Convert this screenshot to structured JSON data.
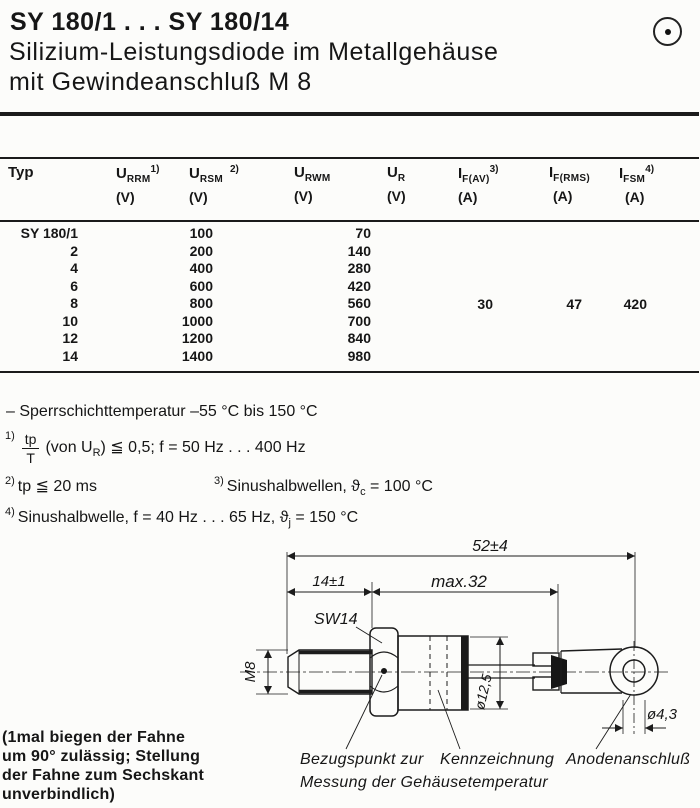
{
  "header": {
    "title": "SY 180/1 . . . SY 180/14",
    "subtitle_line1": "Silizium-Leistungsdiode im Metallgehäuse",
    "subtitle_line2": "mit Gewindeanschluß M 8",
    "logo_icon": "circle-dot-icon"
  },
  "table": {
    "columns": [
      {
        "base": "Typ",
        "sub": "",
        "sup": "",
        "unit": ""
      },
      {
        "base": "U",
        "sub": "RRM",
        "sup": "1)",
        "unit": "(V)"
      },
      {
        "base": "U",
        "sub": "RSM",
        "sup": "2)",
        "unit": "(V)"
      },
      {
        "base": "U",
        "sub": "RWM",
        "sup": "",
        "unit": "(V)"
      },
      {
        "base": "U",
        "sub": "R",
        "sup": "",
        "unit": "(V)"
      },
      {
        "base": "I",
        "sub": "F(AV)",
        "sup": "3)",
        "unit": "(A)"
      },
      {
        "base": "I",
        "sub": "F(RMS)",
        "sup": "",
        "unit": "(A)"
      },
      {
        "base": "I",
        "sub": "FSM",
        "sup": "4)",
        "unit": "(A)"
      }
    ],
    "rows": [
      {
        "typ": "SY 180/1",
        "urrm_ursm": "100",
        "urwm": "70"
      },
      {
        "typ": "2",
        "urrm_ursm": "200",
        "urwm": "140"
      },
      {
        "typ": "4",
        "urrm_ursm": "400",
        "urwm": "280"
      },
      {
        "typ": "6",
        "urrm_ursm": "600",
        "urwm": "420"
      },
      {
        "typ": "8",
        "urrm_ursm": "800",
        "urwm": "560"
      },
      {
        "typ": "10",
        "urrm_ursm": "1000",
        "urwm": "700"
      },
      {
        "typ": "12",
        "urrm_ursm": "1200",
        "urwm": "840"
      },
      {
        "typ": "14",
        "urrm_ursm": "1400",
        "urwm": "980"
      }
    ],
    "shared_values": {
      "if_av": "30",
      "if_rms": "47",
      "ifsm": "420"
    }
  },
  "notes": {
    "temp_range": "– Sperrschichttemperatur  –55 °C bis 150 °C",
    "fn1": {
      "sup": "1)",
      "num": "tp",
      "den": "T",
      "pre": "(von U",
      "sub": "R",
      "post": ")  ≦  0,5;  f = 50 Hz . . . 400 Hz"
    },
    "fn2": {
      "sup": "2)",
      "text": "tp ≦ 20 ms"
    },
    "fn3": {
      "sup": "3)",
      "pre": "Sinushalbwellen,  ϑ",
      "sub": "c",
      "post": " = 100 °C"
    },
    "fn4": {
      "sup": "4)",
      "pre": "Sinushalbwelle,  f = 40 Hz . . . 65 Hz,  ϑ",
      "sub": "j",
      "post": "  = 150 °C"
    }
  },
  "drawing": {
    "dim_total": "52±4",
    "dim_stud": "14±1",
    "dim_body": "max.32",
    "wrench": "SW14",
    "thread": "M8",
    "body_dia": "ø12,5",
    "hole_dia": "ø4,3",
    "ref_label_1": "Bezugspunkt zur",
    "ref_label_2": "Messung der Gehäusetemperatur",
    "marking_label": "Kennzeichnung",
    "anode_label": "Anodenanschluß"
  },
  "footer_note": {
    "l1": "(1mal biegen der Fahne",
    "l2": "um 90° zulässig; Stellung",
    "l3": "der Fahne zum Sechskant",
    "l4": "unverbindlich)"
  },
  "colors": {
    "ink": "#161616",
    "paper": "#fcfcfa"
  }
}
